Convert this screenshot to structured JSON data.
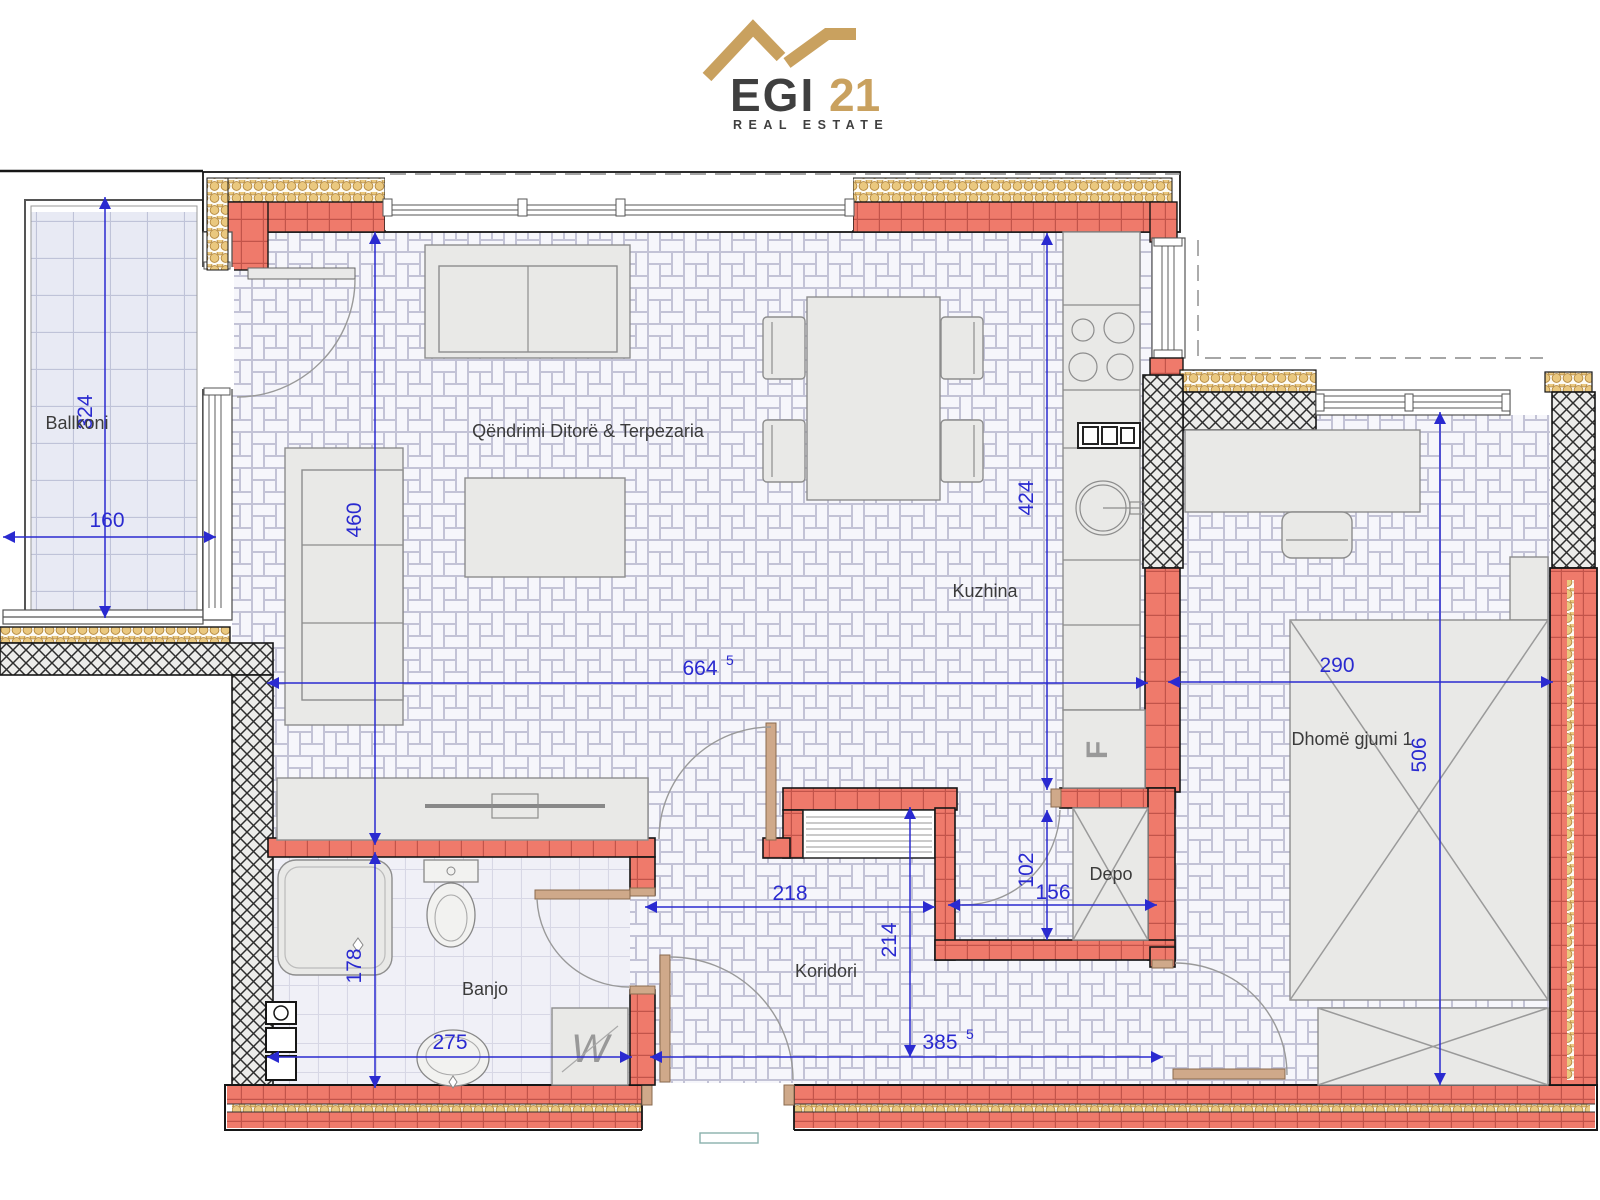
{
  "logo": {
    "name": "EGI",
    "number": "21",
    "tagline": "REAL ESTATE"
  },
  "rooms": {
    "balcony": "Ballkoni",
    "living": "Qëndrimi Ditorë & Terpezaria",
    "kitchen": "Kuzhina",
    "bedroom": "Dhomë gjumi 1",
    "bathroom": "Banjo",
    "corridor": "Koridori",
    "storage": "Depo"
  },
  "dims": {
    "balcony_depth": {
      "value": "324"
    },
    "balcony_width": {
      "value": "160"
    },
    "living_height": {
      "value": "460"
    },
    "living_length": {
      "value": "664",
      "sup": "5"
    },
    "kitchen_depth": {
      "value": "424"
    },
    "bedroom_width": {
      "value": "290"
    },
    "bedroom_depth": {
      "value": "506"
    },
    "storage_height": {
      "value": "102"
    },
    "storage_width": {
      "value": "156"
    },
    "corridor_width": {
      "value": "218"
    },
    "corridor_depth": {
      "value": "214"
    },
    "bath_depth": {
      "value": "178"
    },
    "bath_width": {
      "value": "275"
    },
    "corridor_length": {
      "value": "385",
      "sup": "5"
    }
  },
  "symbols": {
    "fridge": "F",
    "washer": "W"
  },
  "colors": {
    "wall_red": "#ef7a6b",
    "wall_red_joint": "#c2544a",
    "insulation_gold": "#eac87f",
    "dim_blue": "#2a2ad0",
    "floor_bg": "#e6e6f0",
    "floor_tile": "#f6f6fb",
    "floor_joint": "#c3c3d6",
    "logo_gold": "#c9a15f",
    "logo_dark": "#3f3f3f",
    "door_tan": "#cfa98a",
    "furn_fill": "#e9e9e7"
  }
}
